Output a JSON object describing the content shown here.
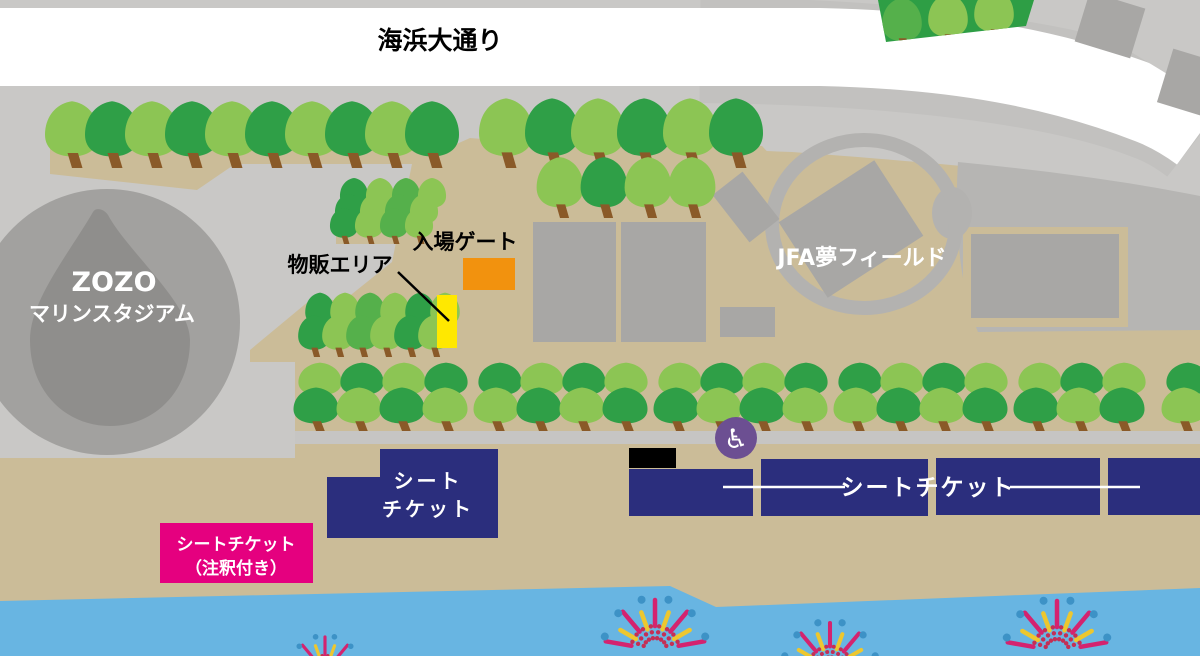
{
  "map": {
    "road_label": "海浜大通り",
    "stadium": {
      "line1": "ZOZO",
      "line2": "マリンスタジアム"
    },
    "jfa_label": "JFA夢フィールド",
    "entrance_gate_label": "入場ゲート",
    "merch_area_label": "物販エリア",
    "seat_ticket_left": {
      "line1": "シート",
      "line2": "チケット"
    },
    "seat_ticket_right_label": "シートチケット",
    "seat_ticket_annotated": {
      "line1": "シートチケット",
      "line2": "（注釈付き）"
    },
    "wheelchair_icon_glyph": "♿"
  },
  "colors": {
    "background_gray": "#c9c8c6",
    "road_white": "#ffffff",
    "curb_gray": "#c2c1bf",
    "sand_tan": "#cbbc98",
    "path_strip_gray": "#c6c5c3",
    "stadium_gray": "#a2a19f",
    "stadium_inner_gray": "#8f8e8c",
    "building_gray": "#a8a7a5",
    "plaza_gray": "#b6b5b3",
    "ring_gray": "#b3b2b0",
    "tree_light": "#8cc554",
    "tree_mid": "#55b04b",
    "tree_dark": "#2f9f47",
    "tree_patch": "#2e9e45",
    "trunk_brown": "#8a5a28",
    "seat_navy": "#2b2e7d",
    "annotated_pink": "#e5007f",
    "gate_orange": "#f2920e",
    "merch_yellow": "#ffe800",
    "wheelchair_purple": "#6c4f92",
    "water_blue": "#68b5e2",
    "firework_magenta": "#d4236f",
    "firework_yellow": "#edc72f",
    "firework_blue": "#3d92c6",
    "firework_crimson": "#c42f55",
    "stage_black": "#000000"
  }
}
